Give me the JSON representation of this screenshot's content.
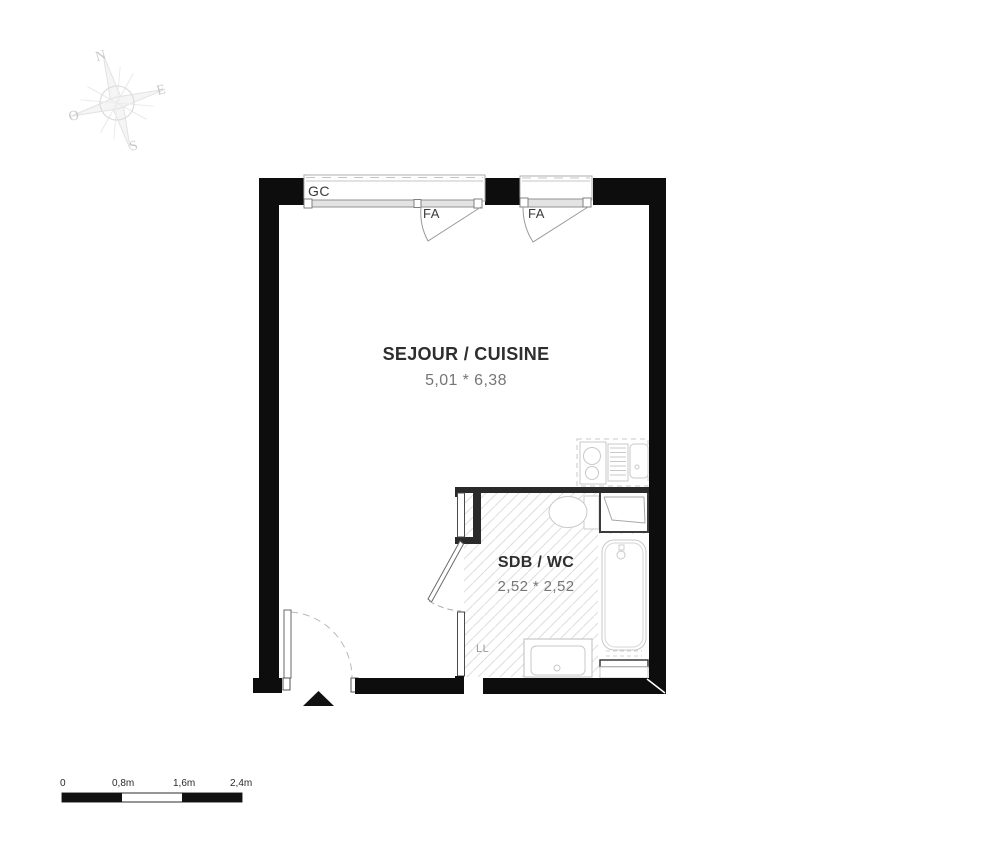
{
  "compass": {
    "north": "N",
    "east": "E",
    "south": "S",
    "west": "O"
  },
  "plan": {
    "labels": {
      "guardrail": "GC",
      "window_1": "FA",
      "window_2": "FA",
      "washing_machine": "LL"
    },
    "rooms": [
      {
        "name": "SEJOUR / CUISINE",
        "dimensions": "5,01 * 6,38"
      },
      {
        "name": "SDB / WC",
        "dimensions": "2,52 * 2,52"
      }
    ]
  },
  "scale_bar": {
    "ticks": [
      "0",
      "0,8m",
      "1,6m",
      "2,4m"
    ]
  },
  "colors": {
    "wall": "#0d0d0d",
    "hatch": "#dedede",
    "fixture": "#c9c9c9"
  }
}
